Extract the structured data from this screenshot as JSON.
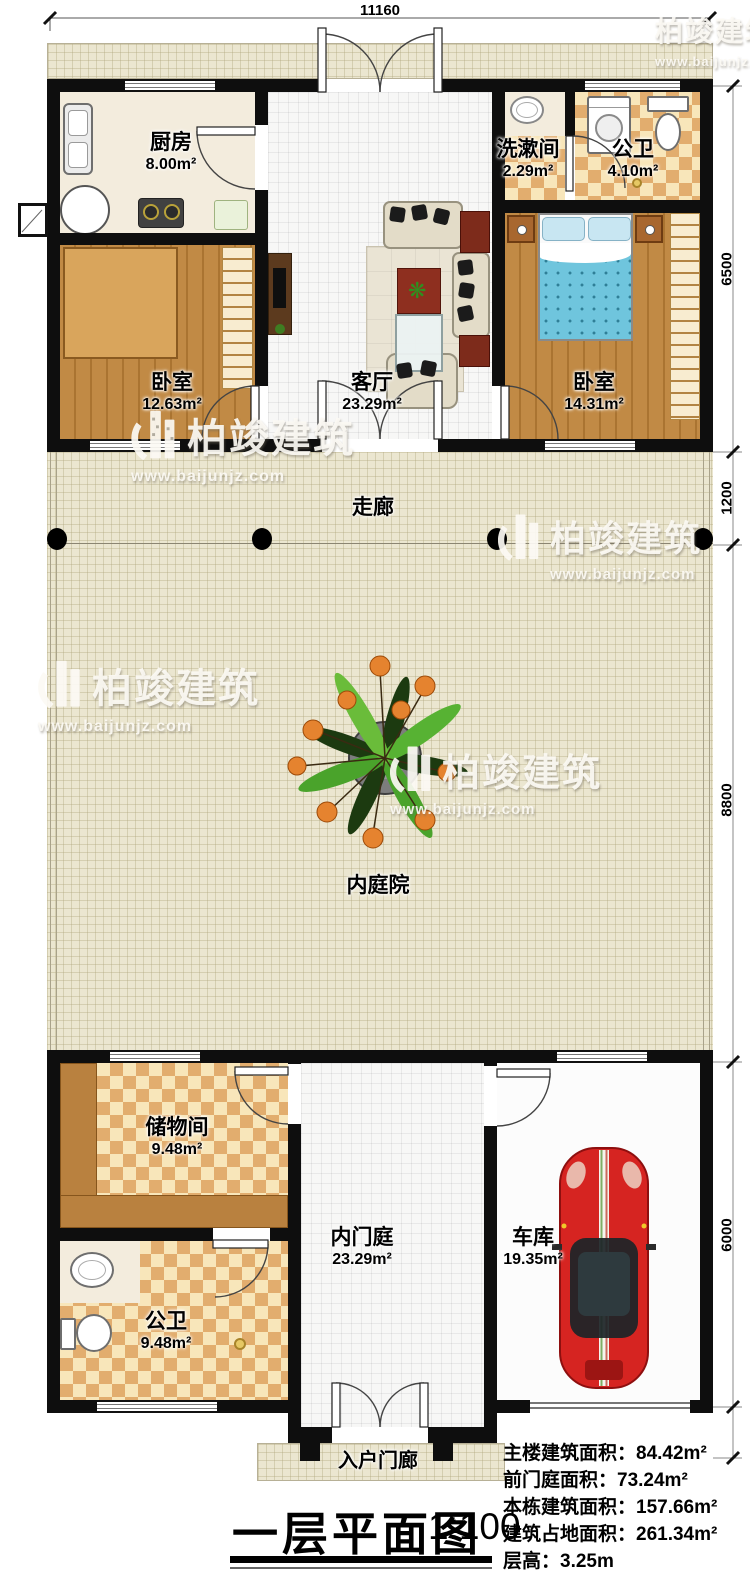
{
  "plan": {
    "title": "一层平面图",
    "scale": "1:100",
    "watermark": {
      "brand": "柏竣建筑",
      "url": "www.baijunjz.com"
    },
    "dimensions": {
      "top": "11160",
      "right": [
        "6500",
        "1200",
        "8800",
        "6000"
      ]
    },
    "rooms": {
      "kitchen": {
        "name": "厨房",
        "area": "8.00m²"
      },
      "washroom": {
        "name": "洗漱间",
        "area": "2.29m²"
      },
      "bath_top": {
        "name": "公卫",
        "area": "4.10m²"
      },
      "bedroom_left": {
        "name": "卧室",
        "area": "12.63m²"
      },
      "living_room": {
        "name": "客厅",
        "area": "23.29m²"
      },
      "bedroom_right": {
        "name": "卧室",
        "area": "14.31m²"
      },
      "corridor": {
        "name": "走廊"
      },
      "courtyard": {
        "name": "内庭院"
      },
      "storage": {
        "name": "储物间",
        "area": "9.48m²"
      },
      "bath_bottom": {
        "name": "公卫",
        "area": "9.48m²"
      },
      "inner_foyer": {
        "name": "内门庭",
        "area": "23.29m²"
      },
      "garage": {
        "name": "车库",
        "area": "19.35m²"
      },
      "porch": {
        "name": "入户门廊"
      }
    },
    "stats": [
      "主楼建筑面积：84.42m²",
      "前门庭面积：73.24m²",
      "本栋建筑面积：157.66m²",
      "建筑占地面积：261.34m²",
      "层高：3.25m"
    ]
  }
}
